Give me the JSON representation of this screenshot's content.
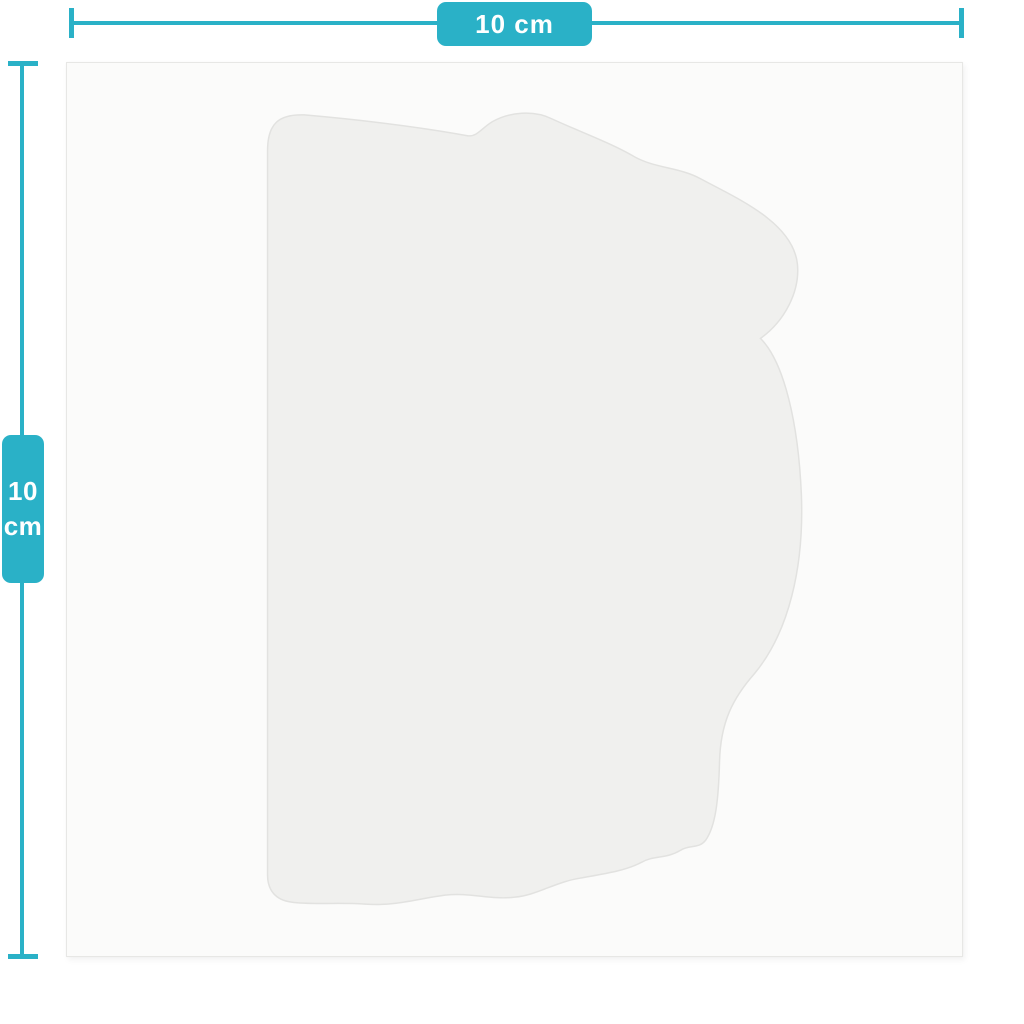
{
  "width_dimension": {
    "label": "10 cm"
  },
  "height_dimension": {
    "value": "10",
    "unit": "cm"
  },
  "colors": {
    "accent_teal": "#2ab1c7",
    "badge_text": "#ffffff",
    "page_background": "#ffffff",
    "sheet_fill": "#fbfbfa",
    "sheet_border": "#e7e7e5",
    "shape_fill": "#f0f0ee",
    "shape_outline": "#e2e2e0"
  },
  "product": {
    "outline_path": "M 201 814 L 201 88 C 201 60 213 51 238 52 C 295 57 352 64 402 73 C 411 74 416 65 426 59 C 443 49 468 47 486 56 C 512 68 547 81 567 93 C 589 106 613 104 635 116 C 670 135 727 159 732 201 C 735 229 719 259 695 276 C 719 300 733 362 736 432 C 739 506 723 571 689 612 C 667 637 655 661 654 700 C 653 739 650 765 640 779 C 633 788 624 783 615 789 C 600 798 588 794 576 801 C 559 810 536 813 514 817 C 489 821 471 834 449 836 C 424 839 404 831 379 834 C 349 838 329 845 299 843 C 269 841 246 844 225 841 C 209 839 201 829 201 814 Z"
  }
}
